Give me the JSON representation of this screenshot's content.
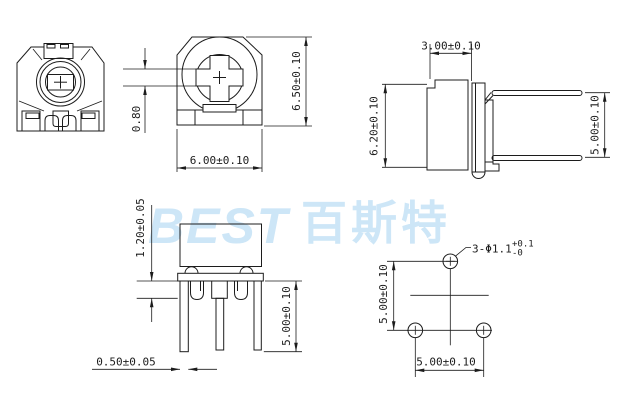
{
  "drawing": {
    "line_color": "#1c1c1c",
    "background_color": "#ffffff",
    "watermark": {
      "latin": "BEST",
      "cjk": "百斯特",
      "color": "#cde6f7"
    },
    "views": {
      "top_view": {
        "height_dim": "6.50±0.10",
        "width_dim": "6.00±0.10",
        "slot_dim": "0.80"
      },
      "side_view": {
        "body_width_dim": "3.00±0.10",
        "body_height_dim": "6.20±0.10",
        "pin_pitch_dim": "5.00±0.10"
      },
      "front_pin_view": {
        "standoff_dim": "1.20±0.05",
        "pin_width_dim": "0.50±0.05",
        "pin_length_dim": "5.00±0.10"
      },
      "footprint_view": {
        "vertical_pitch_dim": "5.00±0.10",
        "horizontal_pitch_dim": "5.00±0.10",
        "hole_callout": "3-Φ1.1",
        "hole_tol_plus": "+0.1",
        "hole_tol_minus": "-0"
      }
    }
  }
}
